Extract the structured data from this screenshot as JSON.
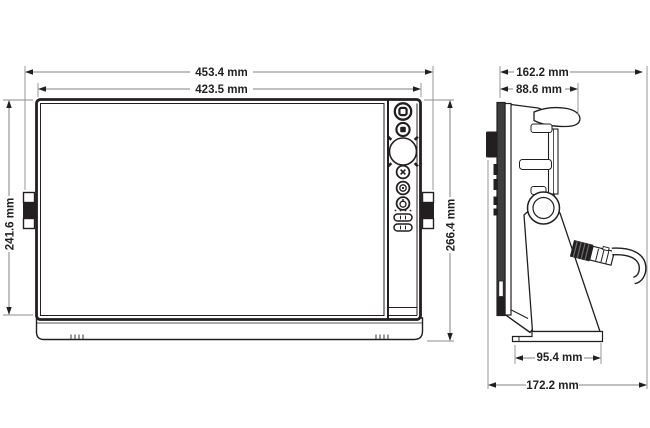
{
  "figure": {
    "kind": "technical-dimension-drawing"
  },
  "dimensions": {
    "front_overall_width": "453.4 mm",
    "front_bezel_width": "423.5 mm",
    "front_bezel_height": "241.6 mm",
    "front_overall_height": "266.4 mm",
    "side_overall_depth": "162.2 mm",
    "side_body_depth": "88.6 mm",
    "side_base_width": "95.4 mm",
    "side_total_depth": "172.2 mm"
  },
  "colors": {
    "line": "#231f20",
    "dimension_line": "#808285",
    "background": "#ffffff",
    "panel_dark": "#3d3e40"
  }
}
